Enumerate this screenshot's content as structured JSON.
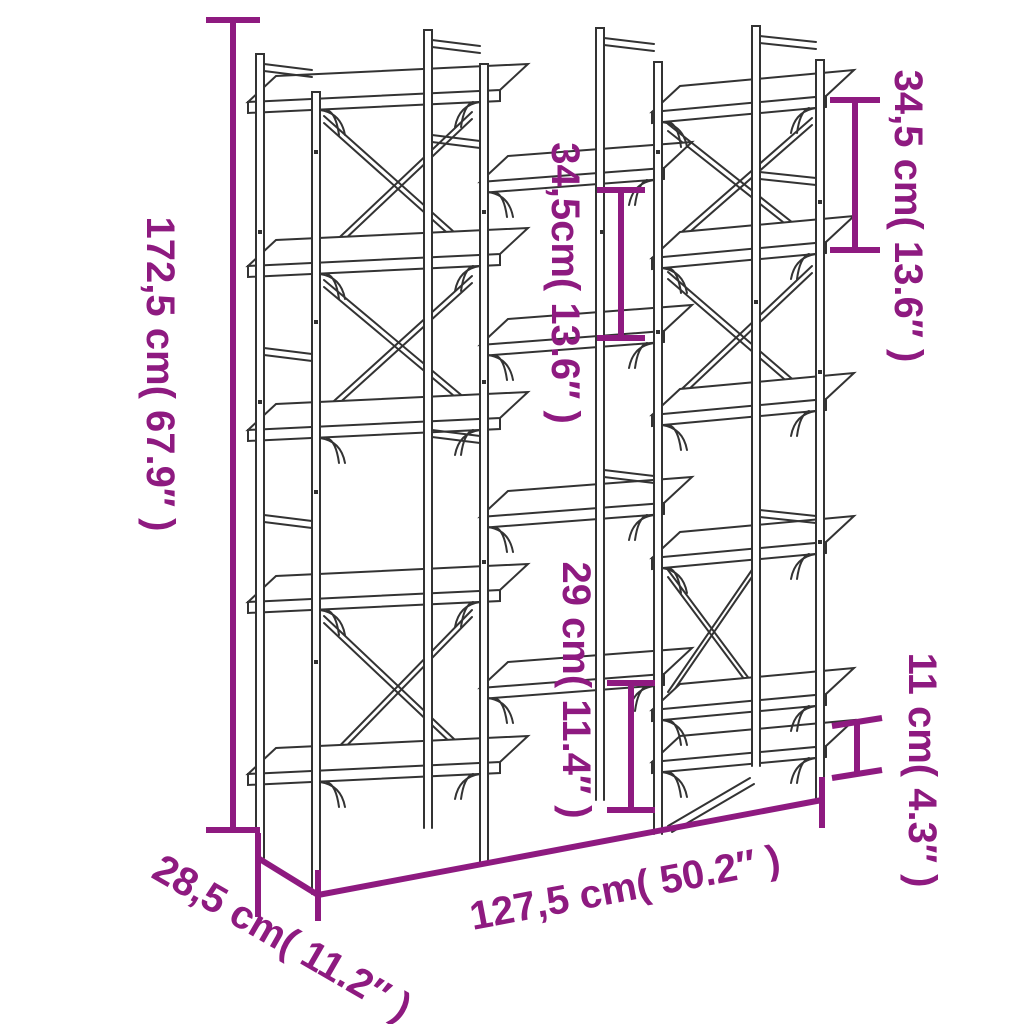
{
  "diagram": {
    "subject": "bookshelf-dimension-diagram",
    "colors": {
      "accent": "#8E1A80",
      "line_art": "#333333",
      "background": "#FFFFFF"
    },
    "dimensions": {
      "height": {
        "cm": "172,5",
        "inches": "67.9",
        "label": "172,5 cm( 67.9″ )"
      },
      "width": {
        "cm": "127,5",
        "inches": "50.2",
        "label": "127,5 cm( 50.2″ )"
      },
      "depth": {
        "cm": "28,5",
        "inches": "11.2",
        "label": "28,5 cm( 11.2″ )"
      },
      "shelf_gap_top_right": {
        "cm": "34,5",
        "inches": "13.6",
        "label": "34,5 cm( 13.6″ )"
      },
      "shelf_gap_middle": {
        "cm": "34,5",
        "inches": "13.6",
        "label": "34,5cm( 13.6″ )"
      },
      "shelf_gap_bottom_middle": {
        "cm": "29",
        "inches": "11.4",
        "label": "29 cm( 11.4″ )"
      },
      "shelf_gap_bottom_right": {
        "cm": "11",
        "inches": "4.3",
        "label": "11 cm( 4.3″ )"
      }
    }
  }
}
